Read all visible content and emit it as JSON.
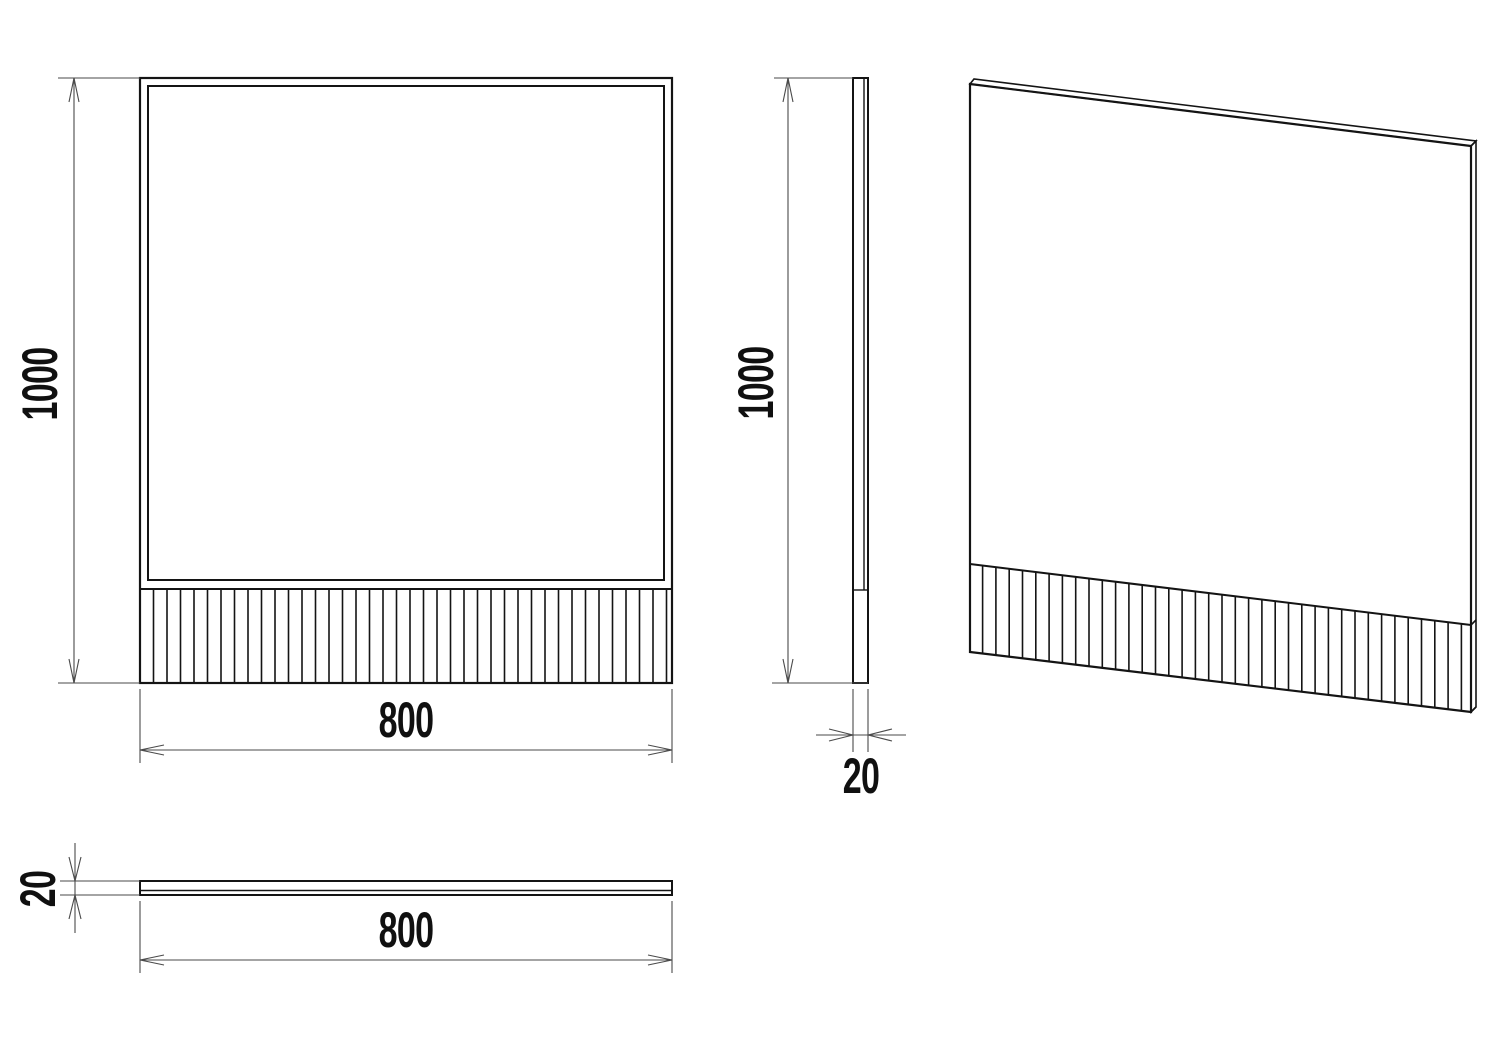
{
  "drawing": {
    "views": {
      "front": {
        "height_label": "1000",
        "width_label": "800"
      },
      "side": {
        "height_label": "1000",
        "thickness_label": "20"
      },
      "top": {
        "width_label": "800",
        "thickness_label": "20"
      }
    },
    "colors": {
      "background": "#ffffff",
      "outline": "#141414",
      "dimension": "#4a4a4a",
      "text": "#101010"
    },
    "flutes": {
      "front_band": {
        "x_start": 153.5,
        "x_end": 671,
        "pitch": 13.5,
        "y_top": 589,
        "y_bottom": 683
      },
      "perspective_band": {
        "x_start": 982.6,
        "x_end": 1470,
        "pitch": 13.3,
        "top_left_y": 564,
        "top_right_y": 625,
        "bottom_left_y": 652,
        "bottom_right_y": 712,
        "x_left": 970,
        "x_right": 1471
      }
    }
  }
}
